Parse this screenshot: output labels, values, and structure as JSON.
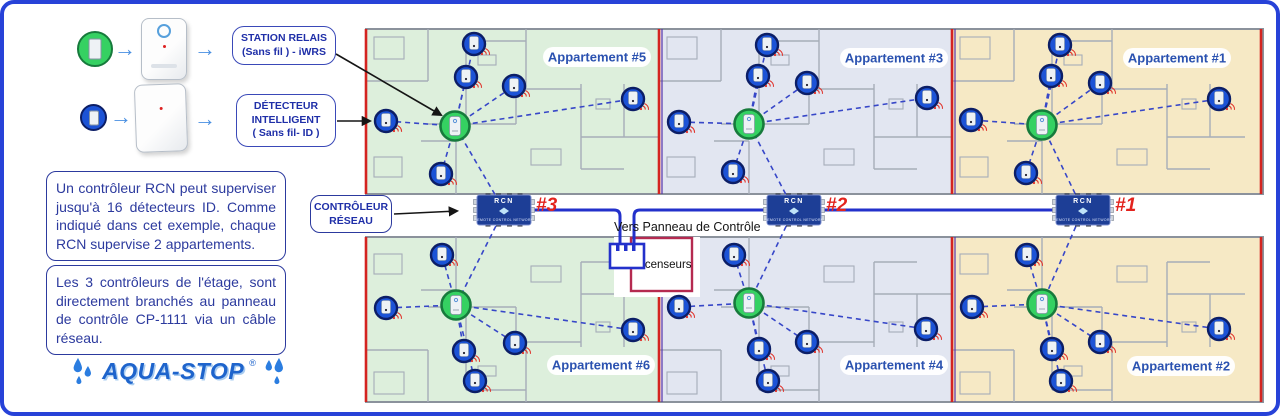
{
  "colors": {
    "border": "#2742d8",
    "wall": "#a6adb8",
    "wall_dark": "#8b929c",
    "red_line": "#d42420",
    "separator_blue": "#5533aa",
    "dash": "#3747c8",
    "cable": "#2331cb",
    "detector": "#1c53d6",
    "detector_ring": "#0c1e66",
    "relay": "#35d162",
    "relay_ring": "#177a3c",
    "rcn_bg": "#1d3e96",
    "red_id": "#e3231d",
    "label_blue": "#2b52b0",
    "signal": "#e03028",
    "elevator_border": "#b52a50"
  },
  "legend": {
    "relay": {
      "lines": [
        "STATION RELAIS",
        "(Sans fil )  - iWRS"
      ]
    },
    "detector": {
      "lines": [
        "DÉTECTEUR",
        "INTELLIGENT",
        "( Sans fil- ID )"
      ]
    }
  },
  "notes": [
    {
      "text": "Un contrôleur RCN peut superviser jusqu'à 16 détecteurs ID. Comme indiqué dans cet exemple, chaque RCN supervise 2 appartements."
    },
    {
      "text": "Les 3 contrôleurs de l'étage, sont directement branchés au panneau de contrôle CP-1111 via un câble réseau."
    }
  ],
  "logo": {
    "text": "AQUA-STOP",
    "registered": "®"
  },
  "controller_label": {
    "lines": [
      "CONTRÔLEUR",
      "RÉSEAU"
    ]
  },
  "corridor": {
    "panel_text": "Vers Panneau de Contrôle",
    "elevator_text": "Ascenseurs"
  },
  "rcn": {
    "title": "RCN",
    "subtitle": "REMOTE CONTROL NETWORK",
    "units": [
      {
        "id": "#3",
        "cx": 500,
        "cy": 206,
        "links": [
          0,
          3
        ]
      },
      {
        "id": "#2",
        "cx": 790,
        "cy": 206,
        "links": [
          1,
          4
        ]
      },
      {
        "id": "#1",
        "cx": 1079,
        "cy": 206,
        "links": [
          2,
          5
        ]
      }
    ]
  },
  "floorplan": {
    "sections": [
      {
        "x": 362,
        "w": 293,
        "tint": "#ddefdc"
      },
      {
        "x": 655,
        "w": 293,
        "tint": "#e2e6f1"
      },
      {
        "x": 948,
        "w": 311,
        "tint": "#f6e9c5"
      }
    ],
    "apartments": [
      {
        "label": "Appartement #5",
        "label_cx": 593,
        "label_cy": 53,
        "section": 0,
        "row": "top",
        "relay": [
          451,
          122
        ],
        "detectors": [
          [
            470,
            40
          ],
          [
            462,
            73
          ],
          [
            510,
            82
          ],
          [
            382,
            117
          ],
          [
            629,
            95
          ],
          [
            437,
            170
          ]
        ]
      },
      {
        "label": "Appartement #3",
        "label_cx": 890,
        "label_cy": 54,
        "section": 1,
        "row": "top",
        "relay": [
          745,
          120
        ],
        "detectors": [
          [
            763,
            41
          ],
          [
            754,
            72
          ],
          [
            803,
            79
          ],
          [
            675,
            118
          ],
          [
            923,
            94
          ],
          [
            729,
            168
          ]
        ]
      },
      {
        "label": "Appartement #1",
        "label_cx": 1173,
        "label_cy": 54,
        "section": 2,
        "row": "top",
        "relay": [
          1038,
          121
        ],
        "detectors": [
          [
            1056,
            41
          ],
          [
            1047,
            72
          ],
          [
            1096,
            79
          ],
          [
            967,
            116
          ],
          [
            1215,
            95
          ],
          [
            1022,
            169
          ]
        ]
      },
      {
        "label": "Appartement #6",
        "label_cx": 597,
        "label_cy": 361,
        "section": 0,
        "row": "bottom",
        "relay": [
          452,
          301
        ],
        "detectors": [
          [
            438,
            251
          ],
          [
            382,
            304
          ],
          [
            460,
            347
          ],
          [
            511,
            339
          ],
          [
            471,
            377
          ],
          [
            629,
            326
          ]
        ]
      },
      {
        "label": "Appartement #4",
        "label_cx": 890,
        "label_cy": 361,
        "section": 1,
        "row": "bottom",
        "relay": [
          745,
          299
        ],
        "detectors": [
          [
            730,
            251
          ],
          [
            675,
            303
          ],
          [
            755,
            345
          ],
          [
            803,
            338
          ],
          [
            764,
            377
          ],
          [
            922,
            325
          ]
        ]
      },
      {
        "label": "Appartement #2",
        "label_cx": 1177,
        "label_cy": 362,
        "section": 2,
        "row": "bottom",
        "relay": [
          1038,
          300
        ],
        "detectors": [
          [
            1023,
            251
          ],
          [
            968,
            303
          ],
          [
            1048,
            345
          ],
          [
            1096,
            338
          ],
          [
            1057,
            377
          ],
          [
            1215,
            325
          ]
        ]
      }
    ]
  }
}
